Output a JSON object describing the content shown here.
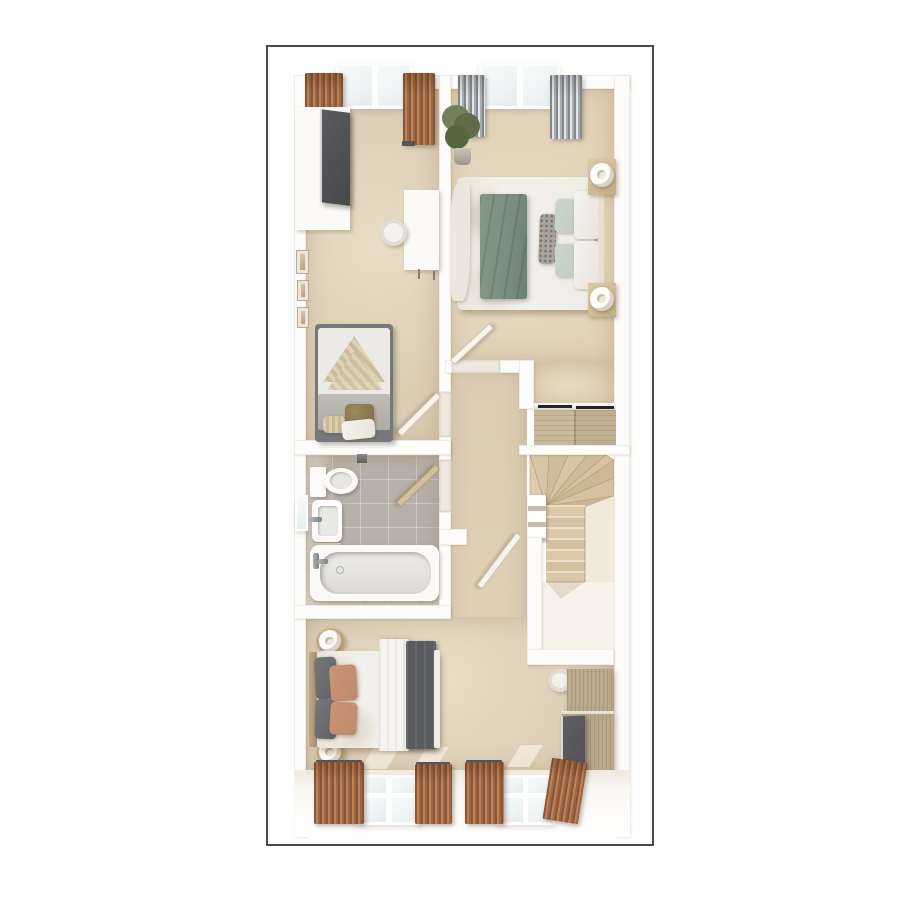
{
  "figure": {
    "kind": "3d-floor-plan-render",
    "view": "top-down dollhouse",
    "label": "First floor 3D floor plan: two bedrooms at top, bathroom and landing with winder staircase in the middle, third bedroom at bottom"
  },
  "palette": {
    "border": "#4a4a4a",
    "wall": "#fdfcfa",
    "sill": "#efe9df",
    "carpet": "#dbccb3",
    "carpetWarm": "#e1d2b6",
    "carpetLight": "#e8dcc6",
    "tile": "#b6b1a9",
    "glass": "#eef3f4",
    "wood": "#c8b99c",
    "woodDark": "#b9a98c",
    "bedFrame": "#77787b",
    "greenThrow": "#7b9080",
    "sage": "#c3cec0",
    "rust": "#c28a6c",
    "throwDark": "#595b5e",
    "doorTan": "#d3c0a0"
  },
  "rooms": {
    "bedroom1": {
      "label": "Main bedroom: double bed with green throw, sage and patterned pillows, two nightstands with sculptural lamps, potted plant, built-in sliding wardrobe, window with gray striped curtains"
    },
    "bedroom3": {
      "label": "Single bedroom: wardrobe with dark front, white desk and chair, single bed with knitted blanket, wall pictures, window with brown curtains"
    },
    "bathroom": {
      "label": "Bathroom: toilet, basin, bathtub, gray tiled floor, side window"
    },
    "landing": {
      "label": "Landing with doors to all rooms"
    },
    "stairs": {
      "label": "Winder staircase turning and descending with white balustrade"
    },
    "bedroom2": {
      "label": "Bottom bedroom: double bed with dark throw, rust and gray pillows, round bedside tables with lamps, wardrobe dresser unit, windows with brown curtains"
    }
  }
}
